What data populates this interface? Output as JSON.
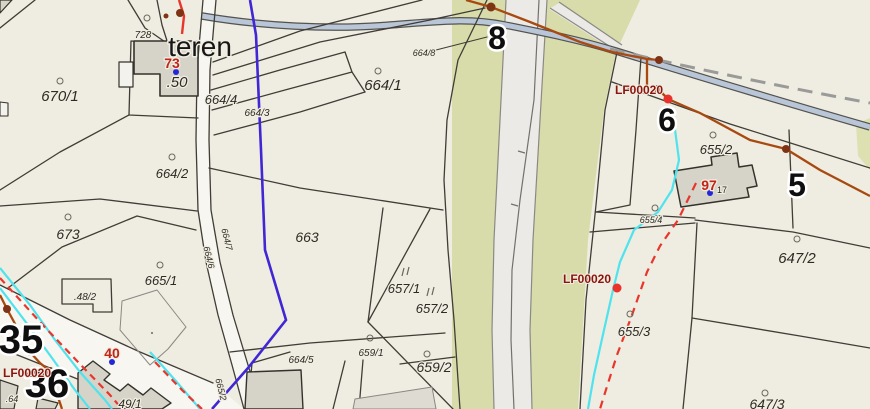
{
  "map": {
    "description": "cadastral parcel map viewer",
    "colors": {
      "background": "#efece1",
      "vegetation_green": "#d8dcab",
      "vegetation_sliver": "#dde1b2",
      "road_fill": "#eceae6",
      "minor_road_fill": "#f7f6f1",
      "road_edge_gray": "#8b8984",
      "stream_fill": "#b9c6d8",
      "stream_bank": "#55534e",
      "dashed_path_gray": "#9a9a98",
      "parcel_line": "#403c36",
      "building_fill": "#d6d3c9",
      "building_faint_fill": "#dedbd2",
      "building_stroke": "#35322c",
      "boundary_indigo": "#4026d4",
      "utility_cyan": "#4fe3ee",
      "utility_red": "#e8362c",
      "utility_orange": "#a8490f",
      "survey_label_red": "#8c140c",
      "point_red": "#e8322a",
      "point_brown": "#7e3414",
      "point_blue": "#2327d8",
      "address_number_red": "#c22418"
    },
    "labels": {
      "area_note": "teren",
      "house_50": ".50"
    },
    "parcel_labels": [
      {
        "text": "670/1"
      },
      {
        "text": "728"
      },
      {
        "text": "664/4"
      },
      {
        "text": "664/3"
      },
      {
        "text": "664/2"
      },
      {
        "text": "673"
      },
      {
        "text": "665/1"
      },
      {
        "text": ".48/2"
      },
      {
        "text": "664/1"
      },
      {
        "text": "664/8"
      },
      {
        "text": "663"
      },
      {
        "text": "657/1"
      },
      {
        "text": "657/2"
      },
      {
        "text": "659/1"
      },
      {
        "text": "659/2"
      },
      {
        "text": "664/5"
      },
      {
        "text": ".64"
      },
      {
        "text": "49/1"
      },
      {
        "text": "655/2"
      },
      {
        "text": "655/4"
      },
      {
        "text": "655/3"
      },
      {
        "text": "647/2"
      },
      {
        "text": "647/3"
      },
      {
        "text": "664/6"
      },
      {
        "text": "664/7"
      },
      {
        "text": "665/2"
      }
    ],
    "big_numbers": [
      "8",
      "6",
      "5",
      "35",
      "36"
    ],
    "address_points": [
      {
        "number": "73"
      },
      {
        "number": "97",
        "sub": "17"
      },
      {
        "number": "40"
      }
    ],
    "survey_labels": [
      "LF00020",
      "LF00020",
      "LF00020"
    ]
  }
}
